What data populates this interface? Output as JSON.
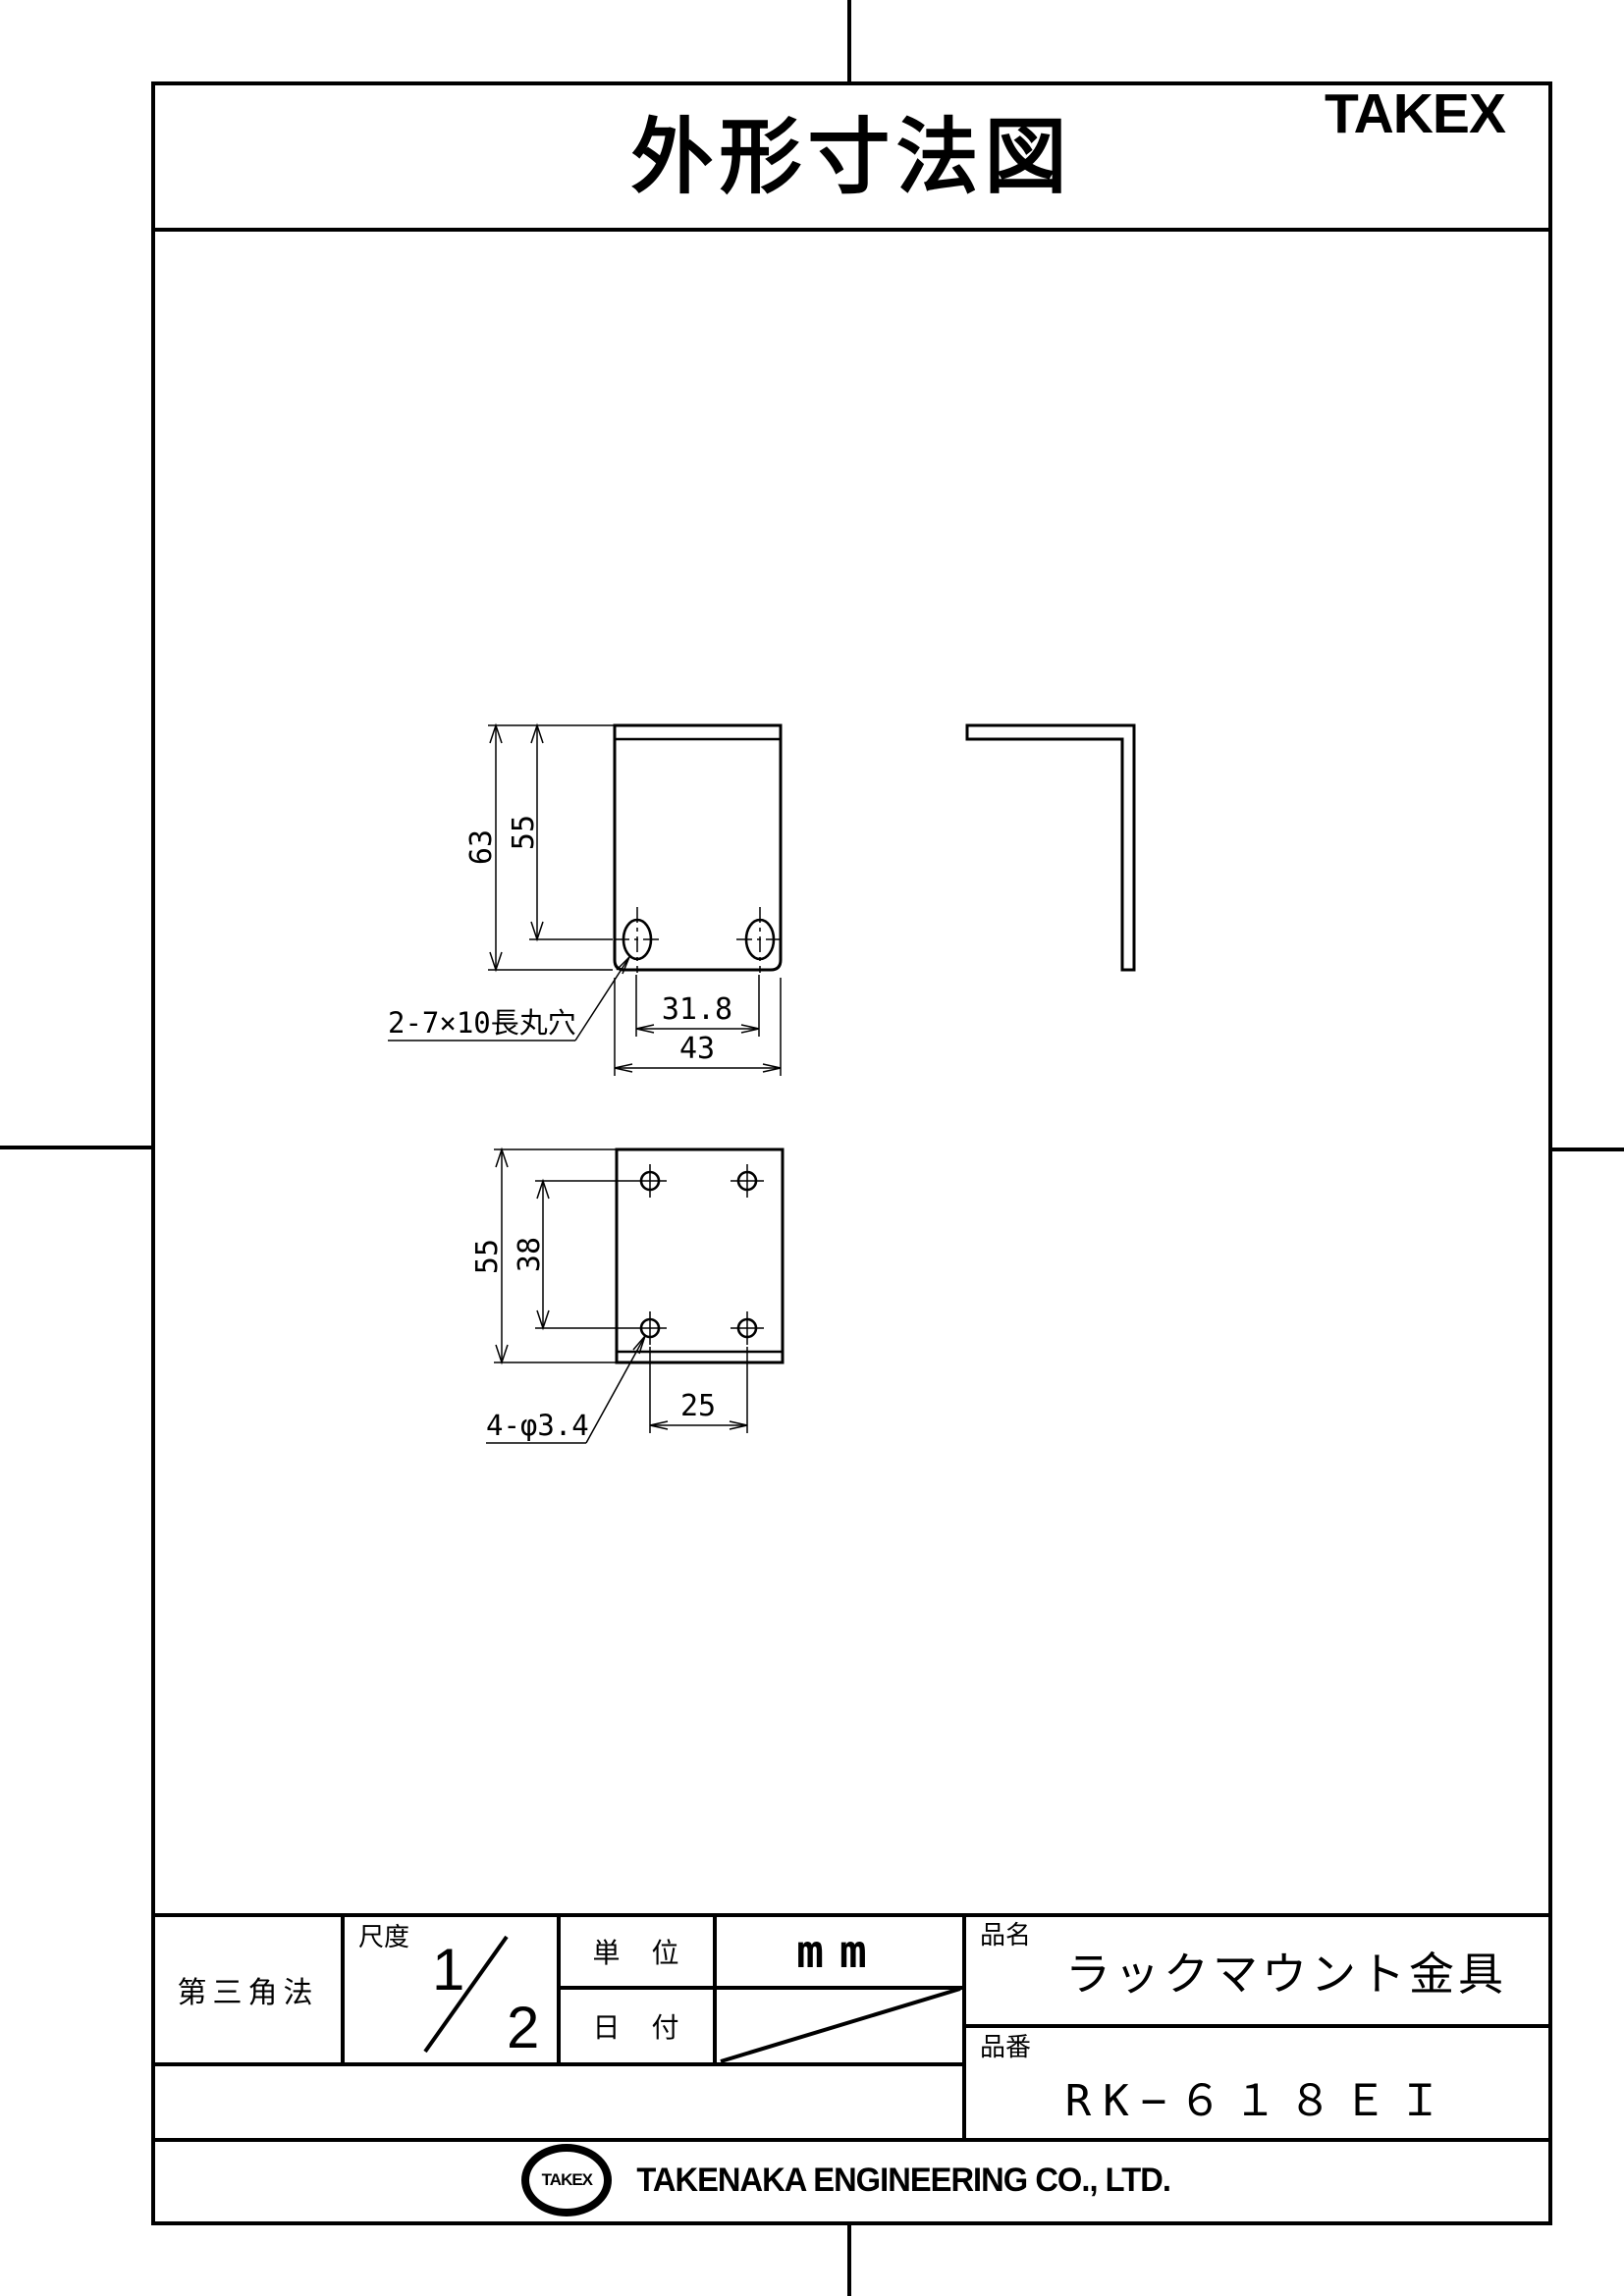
{
  "header": {
    "title": "外形寸法図",
    "brand": "TAKEX"
  },
  "views": {
    "front": {
      "dim_total_height": "63",
      "dim_hole_height": "55",
      "dim_hole_pitch": "31.8",
      "dim_width": "43",
      "hole_label": "2-7×10長丸穴"
    },
    "top": {
      "dim_depth": "55",
      "dim_hole_pitch_depth": "38",
      "dim_hole_pitch_width": "25",
      "hole_label": "4-φ3.4"
    }
  },
  "title_block": {
    "projection": "第三角法",
    "scale_label": "尺度",
    "scale_numerator": "1",
    "scale_denominator": "2",
    "unit_label": "単　位",
    "unit_value": "mm",
    "date_label": "日　付",
    "name_label": "品名",
    "name_value": "ラックマウント金具",
    "number_label": "品番",
    "number_value": "RK−６１８ＥＩ"
  },
  "footer": {
    "logo_text": "TAKEX",
    "company": "TAKENAKA ENGINEERING CO., LTD."
  }
}
